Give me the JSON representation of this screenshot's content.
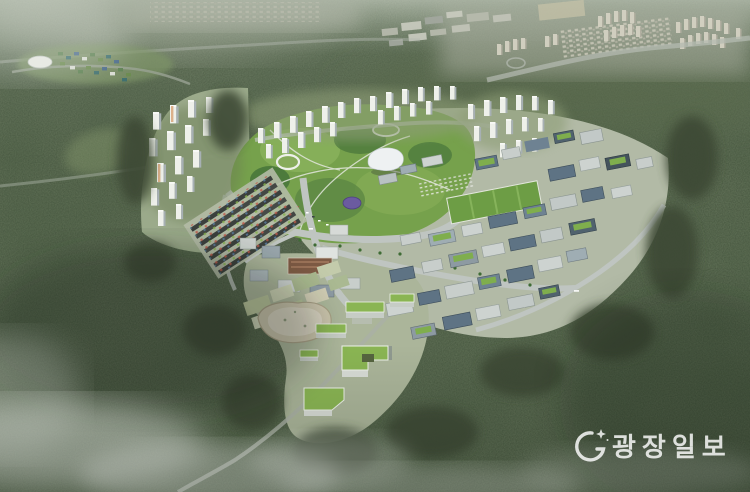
{
  "watermark": {
    "text": "광장일보",
    "color": "#ffffff",
    "opacity": "0.82"
  },
  "scene": {
    "colors": {
      "forest_base": "#47553f",
      "haze": "#dde4d8",
      "park_green": "#76a14c",
      "road_gray": "#bfc5c1",
      "building_white": "#eef0ea",
      "glass_blue": "#5e7384",
      "green_roof": "#8ab553",
      "pond_sand": "#c9c3ab",
      "distant_beige": "#d6d3c4",
      "dome_purple": "#6b5ba0",
      "brown_roof": "#7d5a44"
    }
  }
}
